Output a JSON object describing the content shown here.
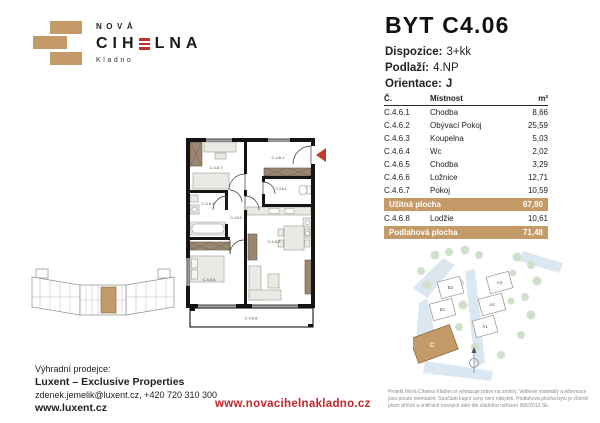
{
  "brand": {
    "name_top": "NOVÁ",
    "name_part1": "CIH",
    "name_part2": "LNA",
    "city": "Kladno"
  },
  "unit": {
    "title": "BYT C4.06",
    "details": [
      {
        "label": "Dispozice:",
        "value": "3+kk"
      },
      {
        "label": "Podlaží:",
        "value": "4.NP"
      },
      {
        "label": "Orientace:",
        "value": "J"
      }
    ]
  },
  "room_table": {
    "col_code": "Č.",
    "col_name": "Místnost",
    "col_area": "m²",
    "rows": [
      {
        "code": "C.4.6.1",
        "name": "Chodba",
        "area": "8,66"
      },
      {
        "code": "C.4.6.2",
        "name": "Obývací Pokoj",
        "area": "25,59"
      },
      {
        "code": "C.4.6.3",
        "name": "Koupelna",
        "area": "5,03"
      },
      {
        "code": "C.4.6.4",
        "name": "Wc",
        "area": "2,02"
      },
      {
        "code": "C.4.6.5",
        "name": "Chodba",
        "area": "3,29"
      },
      {
        "code": "C.4.6.6",
        "name": "Ložnice",
        "area": "12,71"
      },
      {
        "code": "C.4.6.7",
        "name": "Pokoj",
        "area": "10,59"
      }
    ],
    "usable_label": "Užitná plocha",
    "usable_value": "67,90",
    "loggia_row": {
      "code": "C.4.6.8",
      "name": "Lodžie",
      "area": "10,61"
    },
    "floor_label": "Podlahová plocha",
    "floor_value": "71,48"
  },
  "floor_plan": {
    "labels": {
      "hall1": "C.4.6.1",
      "living": "C.4.6.2",
      "bath": "C.4.6.3",
      "wc": "C.4.6.4",
      "hall2": "C.4.6.5",
      "bedroom": "C.4.6.6",
      "room": "C.4.6.7",
      "loggia": "C.4.6.8"
    }
  },
  "site_plan": {
    "buildings": [
      "B2",
      "B1",
      "A3",
      "A2",
      "A1"
    ],
    "current_building": "C"
  },
  "footer": {
    "seller_intro": "Výhradní prodejce:",
    "seller_name": "Luxent – Exclusive Properties",
    "seller_contact": "zdenek.jemelik@luxent.cz, +420 720 310 300",
    "seller_web": "www.luxent.cz",
    "project_web": "www.novacihelnakladno.cz",
    "disclaimer": "Projekt Nová Cihelna Kladno si vyhrazuje právo na změny. Veškeré materiály a informace jsou pouze orientační. Součástí kupní ceny není nábytek. Podlahová plocha bytu je včetně ploch příček a vnitřních nosných stěn dle vládního nařízení 366/2013 Sb."
  },
  "colors": {
    "brick": "#c49a68",
    "red": "#b5372e",
    "text": "#1e1e1e"
  }
}
